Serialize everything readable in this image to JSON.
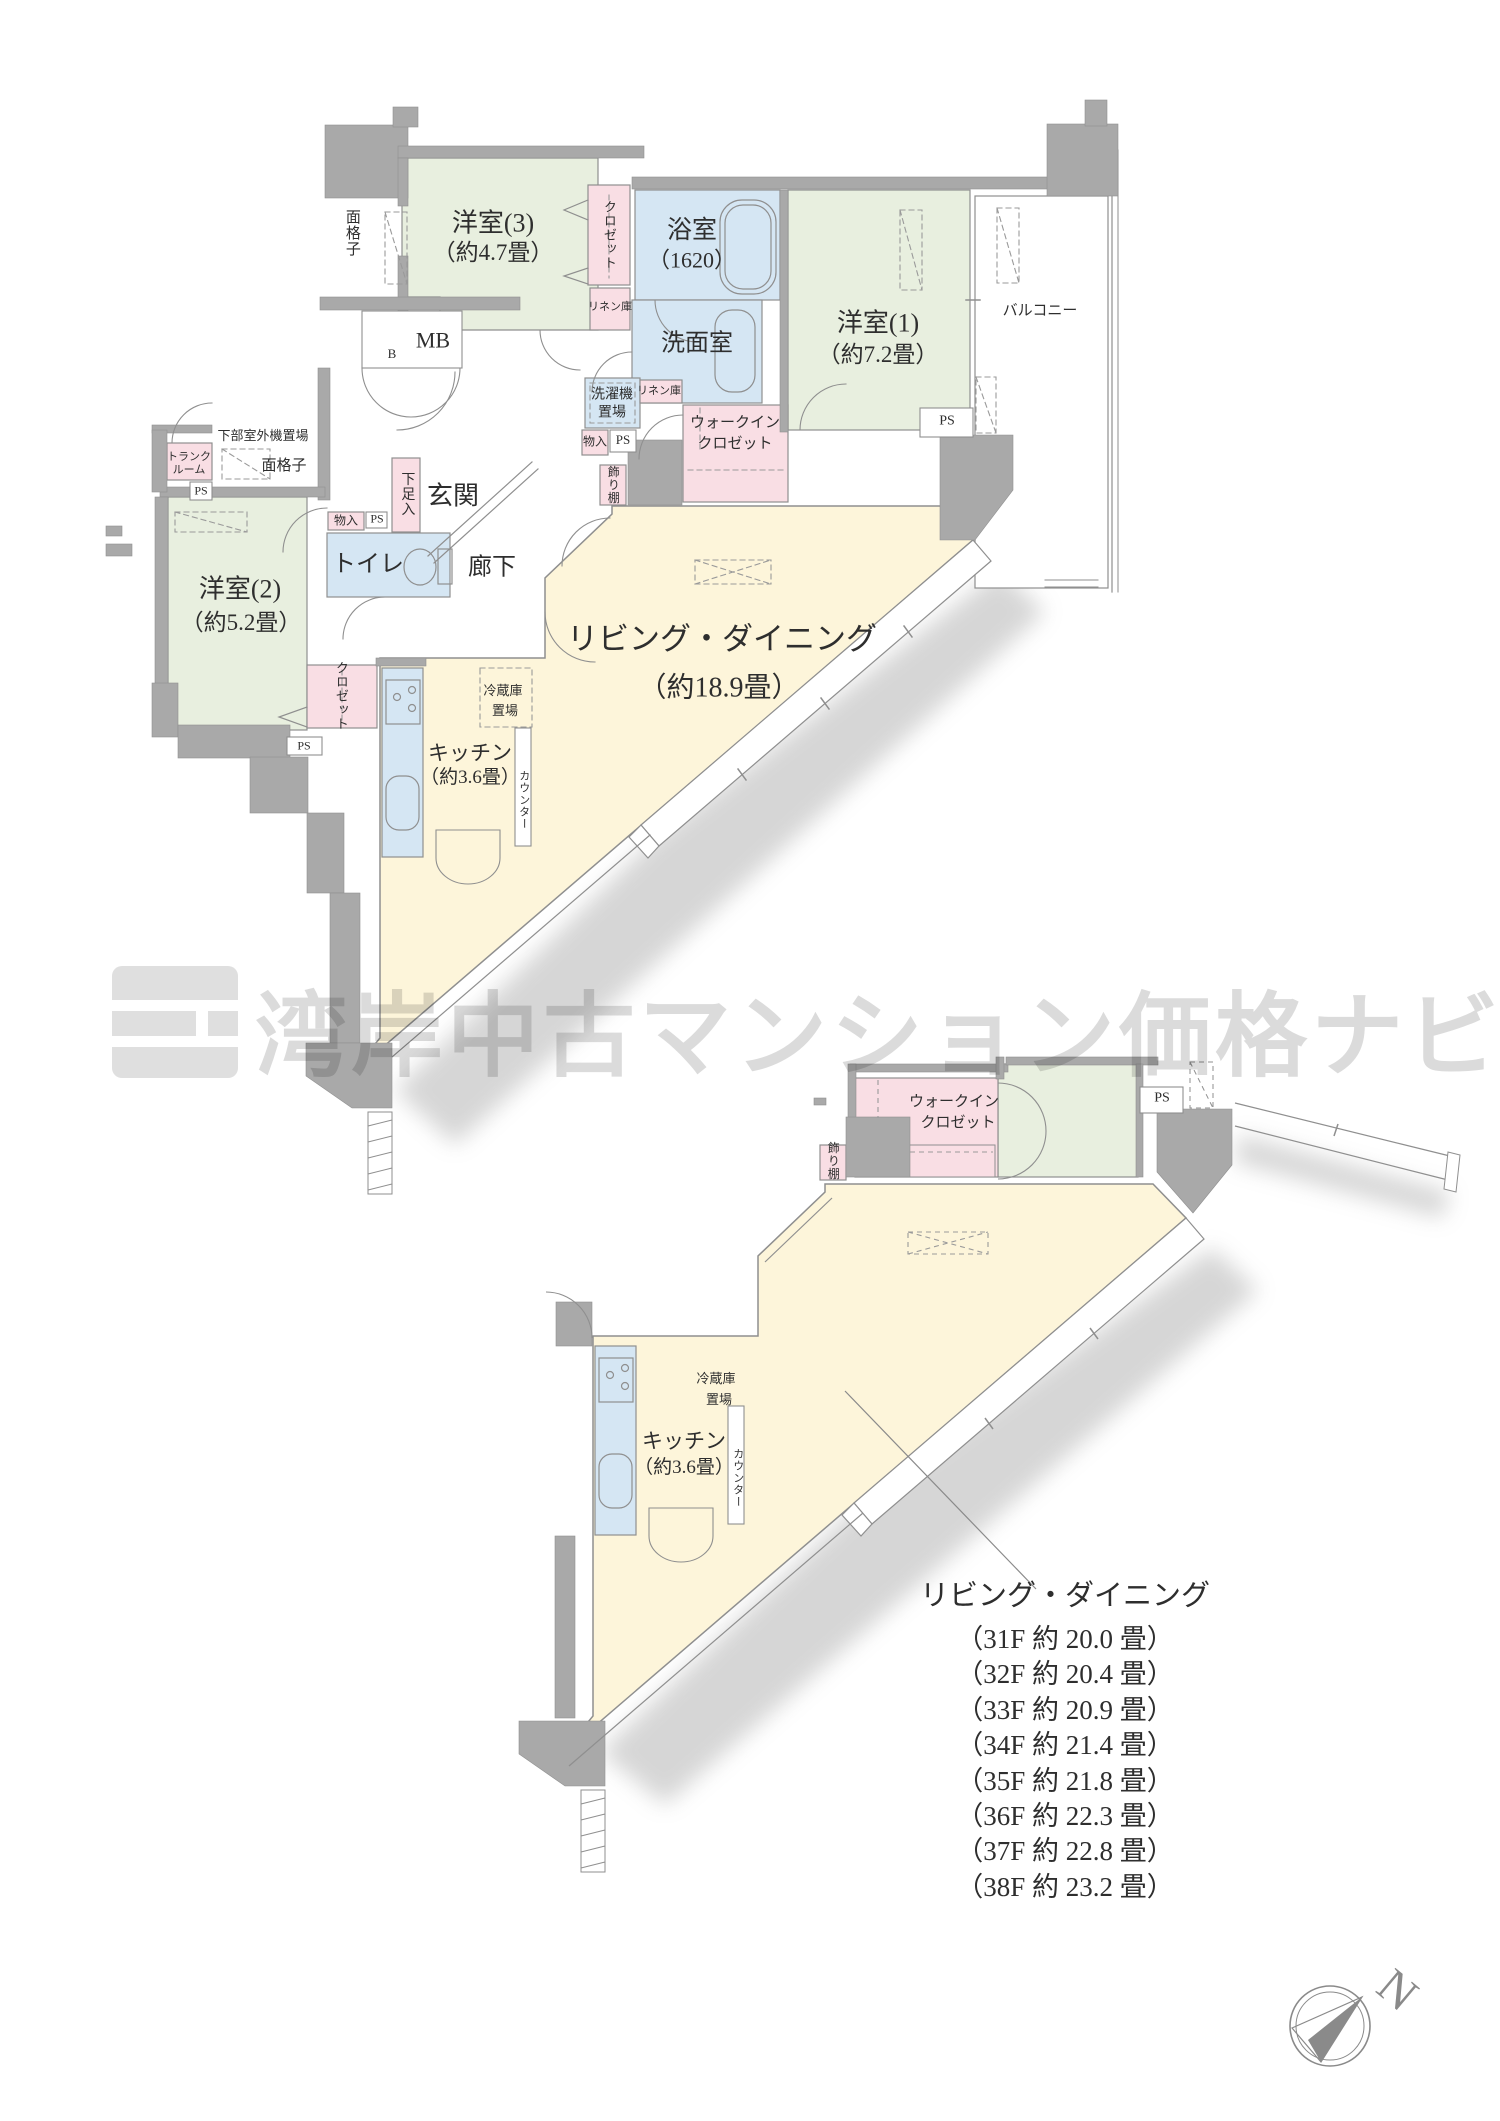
{
  "watermark": {
    "text": "湾岸中古マンション価格ナビ"
  },
  "shared": {
    "ps_label": "PS"
  },
  "colors": {
    "room_green": "#e8efdf",
    "room_blue": "#d5e6f3",
    "closet_pink": "#f9dee4",
    "living_cream": "#fdf5da",
    "wall_gray": "#a9a9a9",
    "line_gray": "#8f8f8f",
    "watermark_gray": "#cfcfcf"
  },
  "upper_plan": {
    "rooms": {
      "yoshitsu3": {
        "name": "洋室(3)",
        "size": "（約4.7畳）"
      },
      "bath": {
        "name": "浴室",
        "size": "（1620）"
      },
      "senmen": {
        "name": "洗面室"
      },
      "yoshitsu1": {
        "name": "洋室(1)",
        "size": "（約7.2畳）"
      },
      "balcony": {
        "name": "バルコニー"
      },
      "mb": {
        "name": "MB",
        "b": "B"
      },
      "genkan": {
        "name": "玄関"
      },
      "toilet": {
        "name": "トイレ"
      },
      "rouka": {
        "name": "廊下"
      },
      "yoshitsu2": {
        "name": "洋室(2)",
        "size": "（約5.2畳）"
      },
      "living": {
        "name": "リビング・ダイニング",
        "size": "（約18.9畳）"
      },
      "kitchen": {
        "name": "キッチン",
        "size": "（約3.6畳）"
      }
    },
    "fixtures": {
      "menkoshi_top": "面格子",
      "closet3": "クロゼット",
      "linen1": "リネン庫",
      "linen2": "リネン庫",
      "sentakuki_1": "洗濯機",
      "sentakuki_2": "置場",
      "wic_1": "ウォークイン",
      "wic_2": "クロゼット",
      "monoire1": "物入",
      "monoire2": "物入",
      "kazaridana": "飾り棚",
      "getabako": "下足入",
      "trunk_1": "トランク",
      "trunk_2": "ルーム",
      "kabu_shitsugaiki": "下部室外機置場",
      "menkoshi2": "面格子",
      "closet2": "クロゼット",
      "reizouko_1": "冷蔵庫",
      "reizouko_2": "置場",
      "counter": "カウンター"
    }
  },
  "lower_plan": {
    "fixtures": {
      "kazaridana": "飾り棚",
      "wic_1": "ウォークイン",
      "wic_2": "クロゼット",
      "reizouko_1": "冷蔵庫",
      "reizouko_2": "置場",
      "counter": "カウンター"
    },
    "rooms": {
      "kitchen": {
        "name": "キッチン",
        "size": "（約3.6畳）"
      }
    }
  },
  "floor_list": {
    "title": "リビング・ダイニング",
    "items": [
      "（31F 約 20.0 畳）",
      "（32F 約 20.4 畳）",
      "（33F 約 20.9 畳）",
      "（34F 約 21.4 畳）",
      "（35F 約 21.8 畳）",
      "（36F 約 22.3 畳）",
      "（37F 約 22.8 畳）",
      "（38F 約 23.2 畳）"
    ]
  },
  "compass": {
    "north_label": "N"
  }
}
